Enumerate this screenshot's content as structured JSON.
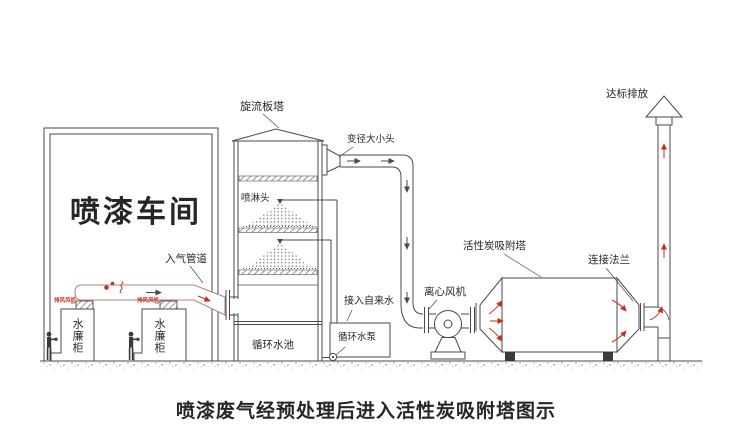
{
  "caption": "喷漆废气经预处理后进入活性炭吸附塔图示",
  "labels": {
    "workshop": "喷漆车间",
    "swirl_tower": "旋流板塔",
    "reducer": "变径大小头",
    "spray_head": "喷淋头",
    "inlet_duct": "入气管道",
    "water_curtain": "水廉柜",
    "exhaust_fan": "排风风机",
    "tap_water": "接入自来水",
    "circulating_pool": "循环水池",
    "circulating_pump": "循环水泵",
    "centrifugal_fan": "离心风机",
    "carbon_tower": "活性炭吸附塔",
    "flange": "连接法兰",
    "discharge": "达标排放"
  },
  "colors": {
    "line": "#4a4a4a",
    "red": "#c2301f",
    "duct": "#b9817e",
    "text": "#262626"
  }
}
